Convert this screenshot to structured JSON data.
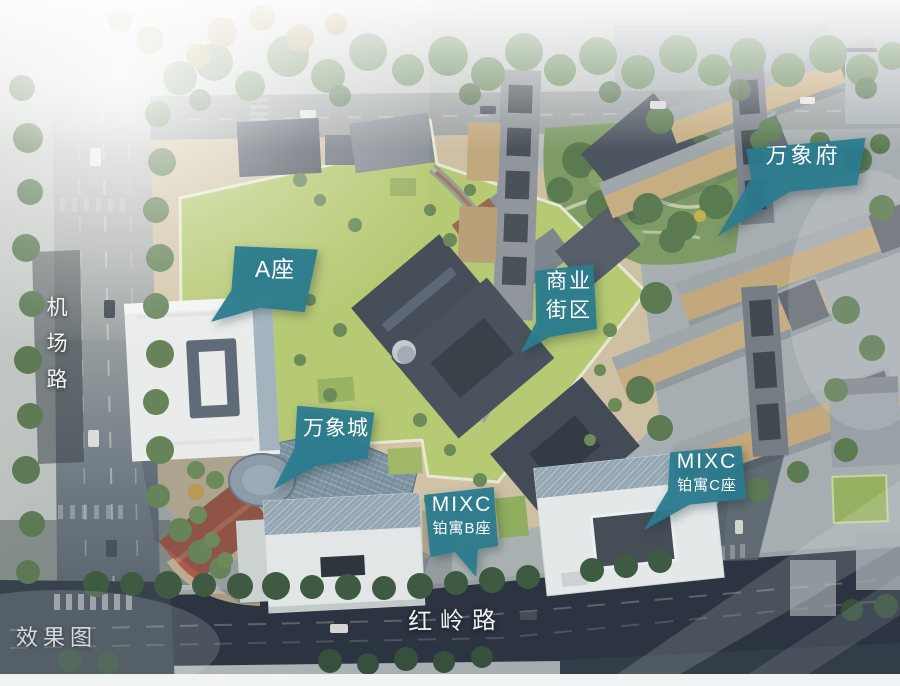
{
  "scene": {
    "description": "Aerial masterplan rendering of a MIXC mixed-use development",
    "watermark": "效果图"
  },
  "roads": {
    "jichang": "机场路",
    "hongling": "红岭路"
  },
  "callouts": {
    "wanxiangfu": {
      "text": "万象府"
    },
    "a_block": {
      "text": "A座"
    },
    "street_block": {
      "line1": "商业",
      "line2": "街区"
    },
    "wanxiangcheng": {
      "text": "万象城"
    },
    "mixc_b": {
      "line1": "MIXC",
      "line2": "铂寓B座"
    },
    "mixc_c": {
      "line1": "MIXC",
      "line2": "铂寓C座"
    }
  },
  "colors": {
    "callout_teal": "#2b7c8f",
    "green_roof": "#b6c973",
    "plaza_tan": "#cec0a3",
    "road_dark": "#2b3440",
    "slate_roof": "#49525d",
    "residential_tan": "#c6ae82",
    "white_building": "#e4e8e8"
  }
}
